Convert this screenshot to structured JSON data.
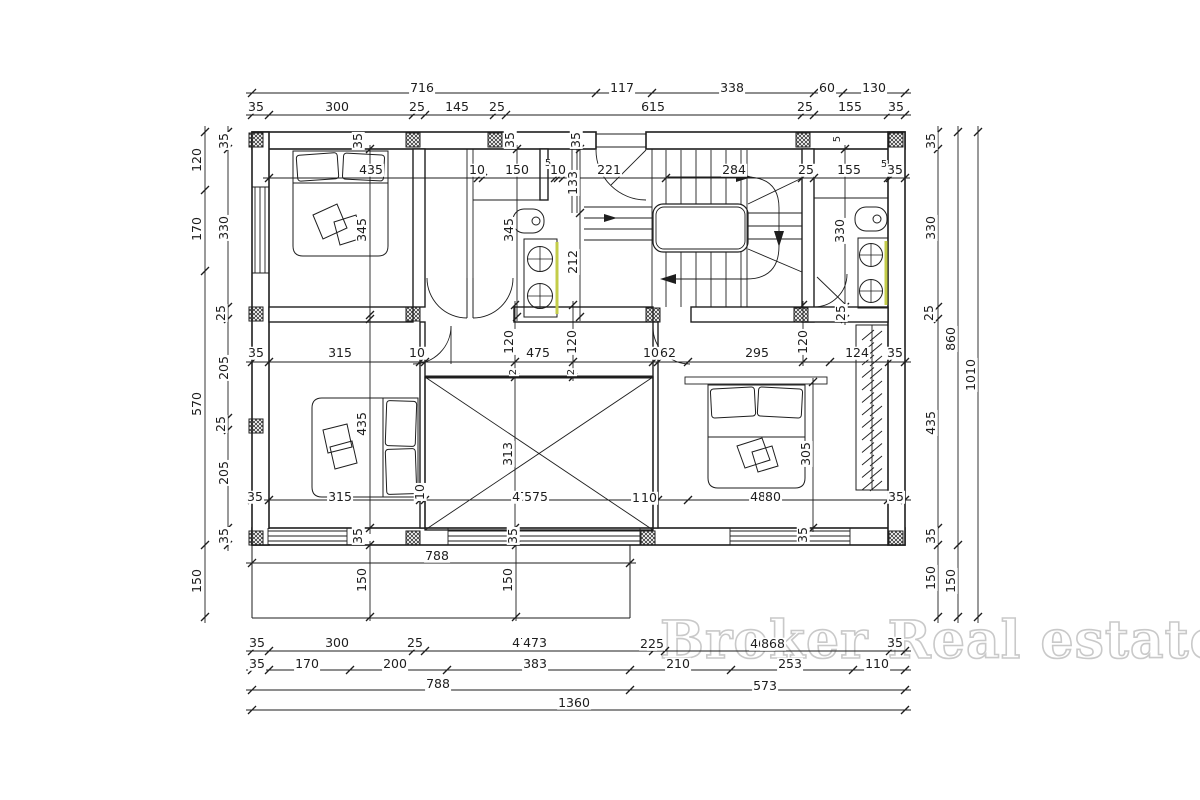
{
  "watermark": {
    "text": "Broker Real estate",
    "color": "#c9c9c9"
  },
  "style": {
    "line_color": "#1e1e1e",
    "fixture_highlight": "#c3cc49"
  },
  "dim_labels": [
    {
      "t": "716",
      "x": 422,
      "y": 88
    },
    {
      "t": "117",
      "x": 622,
      "y": 88
    },
    {
      "t": "338",
      "x": 732,
      "y": 88
    },
    {
      "t": "60",
      "x": 827,
      "y": 88
    },
    {
      "t": "130",
      "x": 874,
      "y": 88
    },
    {
      "t": "35",
      "x": 256,
      "y": 107
    },
    {
      "t": "300",
      "x": 337,
      "y": 107
    },
    {
      "t": "25",
      "x": 417,
      "y": 107
    },
    {
      "t": "145",
      "x": 457,
      "y": 107
    },
    {
      "t": "25",
      "x": 497,
      "y": 107
    },
    {
      "t": "615",
      "x": 653,
      "y": 107
    },
    {
      "t": "25",
      "x": 805,
      "y": 107
    },
    {
      "t": "155",
      "x": 850,
      "y": 107
    },
    {
      "t": "35",
      "x": 896,
      "y": 107
    },
    {
      "t": "435",
      "x": 371,
      "y": 170
    },
    {
      "t": "10",
      "x": 477,
      "y": 170
    },
    {
      "t": "150",
      "x": 517,
      "y": 170
    },
    {
      "t": "5",
      "x": 548,
      "y": 164
    },
    {
      "t": "10",
      "x": 558,
      "y": 170
    },
    {
      "t": "221",
      "x": 609,
      "y": 170
    },
    {
      "t": "284",
      "x": 734,
      "y": 170
    },
    {
      "t": "25",
      "x": 806,
      "y": 170
    },
    {
      "t": "155",
      "x": 849,
      "y": 170
    },
    {
      "t": "5",
      "x": 884,
      "y": 165
    },
    {
      "t": "35",
      "x": 895,
      "y": 170
    },
    {
      "t": "35",
      "x": 358,
      "y": 141,
      "r": 1
    },
    {
      "t": "35",
      "x": 510,
      "y": 140,
      "r": 1
    },
    {
      "t": "35",
      "x": 576,
      "y": 140,
      "r": 1
    },
    {
      "t": "5",
      "x": 838,
      "y": 139,
      "r": 1
    },
    {
      "t": "133",
      "x": 573,
      "y": 183,
      "r": 1
    },
    {
      "t": "212",
      "x": 573,
      "y": 262,
      "r": 1
    },
    {
      "t": "345",
      "x": 362,
      "y": 230,
      "r": 1
    },
    {
      "t": "345",
      "x": 509,
      "y": 230,
      "r": 1
    },
    {
      "t": "330",
      "x": 840,
      "y": 231,
      "r": 1
    },
    {
      "t": "25",
      "x": 841,
      "y": 313,
      "r": 1
    },
    {
      "t": "120",
      "x": 197,
      "y": 160,
      "r": 1
    },
    {
      "t": "170",
      "x": 197,
      "y": 229,
      "r": 1
    },
    {
      "t": "570",
      "x": 197,
      "y": 404,
      "r": 1
    },
    {
      "t": "150",
      "x": 197,
      "y": 581,
      "r": 1
    },
    {
      "t": "35",
      "x": 224,
      "y": 141,
      "r": 1
    },
    {
      "t": "330",
      "x": 224,
      "y": 228,
      "r": 1
    },
    {
      "t": "25",
      "x": 221,
      "y": 313,
      "r": 1
    },
    {
      "t": "205",
      "x": 224,
      "y": 368,
      "r": 1
    },
    {
      "t": "25",
      "x": 221,
      "y": 424,
      "r": 1
    },
    {
      "t": "205",
      "x": 224,
      "y": 473,
      "r": 1
    },
    {
      "t": "35",
      "x": 224,
      "y": 536,
      "r": 1
    },
    {
      "t": "35",
      "x": 931,
      "y": 141,
      "r": 1
    },
    {
      "t": "330",
      "x": 931,
      "y": 228,
      "r": 1
    },
    {
      "t": "25",
      "x": 929,
      "y": 313,
      "r": 1
    },
    {
      "t": "435",
      "x": 931,
      "y": 423,
      "r": 1
    },
    {
      "t": "35",
      "x": 931,
      "y": 536,
      "r": 1
    },
    {
      "t": "150",
      "x": 931,
      "y": 578,
      "r": 1
    },
    {
      "t": "860",
      "x": 951,
      "y": 339,
      "r": 1
    },
    {
      "t": "150",
      "x": 951,
      "y": 581,
      "r": 1
    },
    {
      "t": "1010",
      "x": 971,
      "y": 375,
      "r": 1
    },
    {
      "t": "35",
      "x": 256,
      "y": 353
    },
    {
      "t": "315",
      "x": 340,
      "y": 353
    },
    {
      "t": "10",
      "x": 417,
      "y": 353
    },
    {
      "t": "120",
      "x": 509,
      "y": 342,
      "r": 1
    },
    {
      "t": "475",
      "x": 538,
      "y": 353
    },
    {
      "t": "120",
      "x": 572,
      "y": 342,
      "r": 1
    },
    {
      "t": "10",
      "x": 651,
      "y": 353
    },
    {
      "t": "62",
      "x": 668,
      "y": 353
    },
    {
      "t": "295",
      "x": 757,
      "y": 353
    },
    {
      "t": "120",
      "x": 803,
      "y": 342,
      "r": 1
    },
    {
      "t": "124",
      "x": 857,
      "y": 353
    },
    {
      "t": "35",
      "x": 895,
      "y": 353
    },
    {
      "t": "2",
      "x": 514,
      "y": 372,
      "r": 1
    },
    {
      "t": "2",
      "x": 572,
      "y": 372,
      "r": 1
    },
    {
      "t": "35",
      "x": 255,
      "y": 497
    },
    {
      "t": "315",
      "x": 340,
      "y": 497
    },
    {
      "t": "10",
      "x": 420,
      "y": 492,
      "r": 1
    },
    {
      "t": "475",
      "x": 524,
      "y": 497
    },
    {
      "t": "575",
      "x": 536,
      "y": 497
    },
    {
      "t": "10",
      "x": 640,
      "y": 498
    },
    {
      "t": "10",
      "x": 649,
      "y": 498
    },
    {
      "t": "480",
      "x": 762,
      "y": 497
    },
    {
      "t": "80",
      "x": 773,
      "y": 497
    },
    {
      "t": "35",
      "x": 896,
      "y": 497
    },
    {
      "t": "435",
      "x": 362,
      "y": 424,
      "r": 1
    },
    {
      "t": "313",
      "x": 508,
      "y": 454,
      "r": 1
    },
    {
      "t": "305",
      "x": 806,
      "y": 454,
      "r": 1
    },
    {
      "t": "35",
      "x": 358,
      "y": 536,
      "r": 1
    },
    {
      "t": "35",
      "x": 513,
      "y": 536,
      "r": 1
    },
    {
      "t": "35",
      "x": 803,
      "y": 535,
      "r": 1
    },
    {
      "t": "788",
      "x": 437,
      "y": 556
    },
    {
      "t": "150",
      "x": 362,
      "y": 580,
      "r": 1
    },
    {
      "t": "150",
      "x": 508,
      "y": 580,
      "r": 1
    },
    {
      "t": "35",
      "x": 257,
      "y": 643
    },
    {
      "t": "300",
      "x": 337,
      "y": 643
    },
    {
      "t": "25",
      "x": 415,
      "y": 643
    },
    {
      "t": "474",
      "x": 524,
      "y": 643
    },
    {
      "t": "473",
      "x": 535,
      "y": 643
    },
    {
      "t": "25",
      "x": 648,
      "y": 644
    },
    {
      "t": "25",
      "x": 656,
      "y": 644
    },
    {
      "t": "468",
      "x": 762,
      "y": 644
    },
    {
      "t": "868",
      "x": 773,
      "y": 644
    },
    {
      "t": "35",
      "x": 895,
      "y": 643
    },
    {
      "t": "35",
      "x": 257,
      "y": 664
    },
    {
      "t": "170",
      "x": 307,
      "y": 664
    },
    {
      "t": "200",
      "x": 395,
      "y": 664
    },
    {
      "t": "383",
      "x": 535,
      "y": 664
    },
    {
      "t": "210",
      "x": 678,
      "y": 664
    },
    {
      "t": "253",
      "x": 790,
      "y": 664
    },
    {
      "t": "110",
      "x": 877,
      "y": 664
    },
    {
      "t": "788",
      "x": 438,
      "y": 684
    },
    {
      "t": "573",
      "x": 765,
      "y": 686
    },
    {
      "t": "1360",
      "x": 574,
      "y": 703
    }
  ]
}
